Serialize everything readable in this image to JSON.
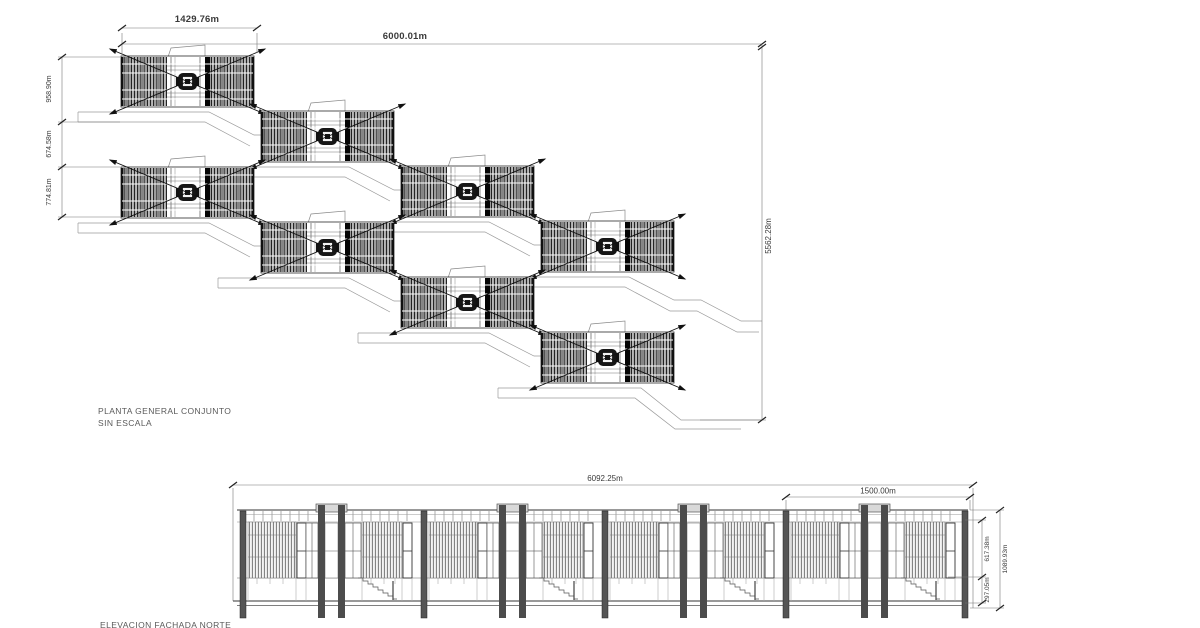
{
  "plan": {
    "title": "PLANTA GENERAL CONJUNTO",
    "scale_note": "SIN ESCALA",
    "dims": {
      "unit_width": "1429.76m",
      "total_width": "6000.01m",
      "left_upper": "958.90m",
      "left_middle": "674.58m",
      "left_lower": "774.81m",
      "right_total": "5562.28m"
    }
  },
  "elevation": {
    "title": "ELEVACION FACHADA NORTE",
    "dims": {
      "total_width": "6092.25m",
      "module_width": "1500.00m",
      "right_upper": "617.38m",
      "right_lower": "297.05m",
      "right_total": "1089.93m"
    }
  },
  "colors": {
    "line": "#333333",
    "hatch_dark": "#111111",
    "background": "#ffffff"
  }
}
